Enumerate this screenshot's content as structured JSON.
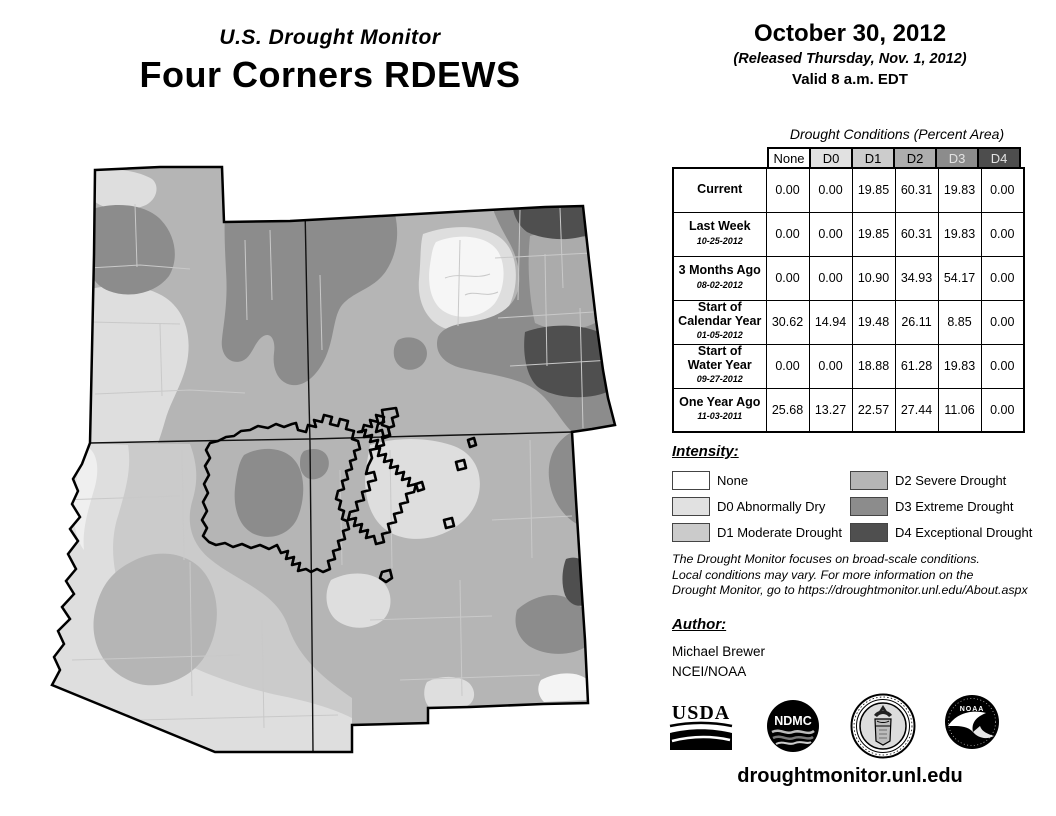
{
  "header": {
    "title_small": "U.S. Drought Monitor",
    "title_large": "Four Corners RDEWS",
    "date": "October 30, 2012",
    "released": "(Released Thursday, Nov. 1, 2012)",
    "valid": "Valid 8 a.m. EDT"
  },
  "table": {
    "title": "Drought Conditions (Percent Area)",
    "columns": [
      "None",
      "D0",
      "D1",
      "D2",
      "D3",
      "D4"
    ],
    "header_colors": [
      "#ffffff",
      "#e1e1e1",
      "#cccccc",
      "#adadad",
      "#8c8c8c",
      "#4d4d4d"
    ],
    "rows": [
      {
        "label": "Current",
        "label2": null,
        "date": null,
        "values": [
          "0.00",
          "0.00",
          "19.85",
          "60.31",
          "19.83",
          "0.00"
        ]
      },
      {
        "label": "Last Week",
        "label2": null,
        "date": "10-25-2012",
        "values": [
          "0.00",
          "0.00",
          "19.85",
          "60.31",
          "19.83",
          "0.00"
        ]
      },
      {
        "label": "3 Months Ago",
        "label2": null,
        "date": "08-02-2012",
        "values": [
          "0.00",
          "0.00",
          "10.90",
          "34.93",
          "54.17",
          "0.00"
        ]
      },
      {
        "label": "Start of",
        "label2": "Calendar Year",
        "date": "01-05-2012",
        "values": [
          "30.62",
          "14.94",
          "19.48",
          "26.11",
          "8.85",
          "0.00"
        ]
      },
      {
        "label": "Start of",
        "label2": "Water Year",
        "date": "09-27-2012",
        "values": [
          "0.00",
          "0.00",
          "18.88",
          "61.28",
          "19.83",
          "0.00"
        ]
      },
      {
        "label": "One Year Ago",
        "label2": null,
        "date": "11-03-2011",
        "values": [
          "25.68",
          "13.27",
          "22.57",
          "27.44",
          "11.06",
          "0.00"
        ]
      }
    ]
  },
  "legend": {
    "heading": "Intensity:",
    "items": [
      {
        "label": "None",
        "color": "#ffffff"
      },
      {
        "label": "D0 Abnormally Dry",
        "color": "#e1e1e1"
      },
      {
        "label": "D1 Moderate Drought",
        "color": "#cbcbcb"
      },
      {
        "label": "D2 Severe Drought",
        "color": "#b5b5b5"
      },
      {
        "label": "D3 Extreme Drought",
        "color": "#8c8c8c"
      },
      {
        "label": "D4 Exceptional Drought",
        "color": "#4f4f4f"
      }
    ]
  },
  "disclaimer": {
    "line1": "The Drought Monitor focuses on broad-scale conditions.",
    "line2": "Local conditions may vary. For more information on the",
    "line3": "Drought Monitor, go to https://droughtmonitor.unl.edu/About.aspx"
  },
  "author": {
    "heading": "Author:",
    "name": "Michael Brewer",
    "org": "NCEI/NOAA"
  },
  "logos": {
    "usda_text": "USDA",
    "ndmc_text": "NDMC",
    "noaa_text": "NOAA"
  },
  "footer": {
    "url": "droughtmonitor.unl.edu"
  }
}
